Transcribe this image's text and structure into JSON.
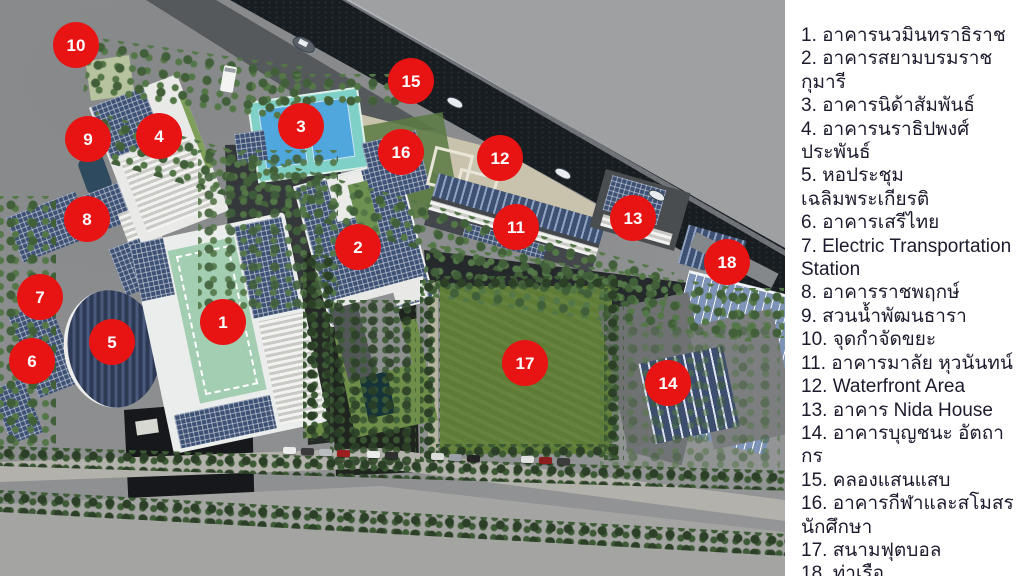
{
  "legend": {
    "items": [
      {
        "number": "1",
        "label": "อาคารนวมินทราธิราช"
      },
      {
        "number": "2",
        "label": "อาคารสยามบรมราชกุมารี"
      },
      {
        "number": "3",
        "label": "อาคารนิด้าสัมพันธ์"
      },
      {
        "number": "4",
        "label": "อาคารนราธิปพงศ์ประพันธ์"
      },
      {
        "number": "5",
        "label": "หอประชุมเฉลิมพระเกียรติ"
      },
      {
        "number": "6",
        "label": "อาคารเสรีไทย"
      },
      {
        "number": "7",
        "label": "Electric Transportation Station"
      },
      {
        "number": "8",
        "label": "อาคารราชพฤกษ์"
      },
      {
        "number": "9",
        "label": "สวนน้ำพัฒนธารา"
      },
      {
        "number": "10",
        "label": "จุดกำจัดขยะ"
      },
      {
        "number": "11",
        "label": "อาคารมาลัย หุวนันทน์"
      },
      {
        "number": "12",
        "label": "Waterfront Area"
      },
      {
        "number": "13",
        "label": "อาคาร Nida House"
      },
      {
        "number": "14",
        "label": "อาคารบุญชนะ อัตถากร"
      },
      {
        "number": "15",
        "label": "คลองแสนแสบ"
      },
      {
        "number": "16",
        "label": "อาคารกีฬาและสโมสรนักศึกษา"
      },
      {
        "number": "17",
        "label": "สนามฟุตบอล"
      },
      {
        "number": "18",
        "label": "ท่าเรือ"
      }
    ]
  },
  "map": {
    "markers": [
      {
        "number": "1",
        "x": 223,
        "y": 322
      },
      {
        "number": "2",
        "x": 358,
        "y": 247
      },
      {
        "number": "3",
        "x": 301,
        "y": 126
      },
      {
        "number": "4",
        "x": 159,
        "y": 136
      },
      {
        "number": "5",
        "x": 112,
        "y": 342
      },
      {
        "number": "6",
        "x": 32,
        "y": 361
      },
      {
        "number": "7",
        "x": 40,
        "y": 297
      },
      {
        "number": "8",
        "x": 87,
        "y": 219
      },
      {
        "number": "9",
        "x": 88,
        "y": 139
      },
      {
        "number": "10",
        "x": 76,
        "y": 45
      },
      {
        "number": "11",
        "x": 516,
        "y": 227
      },
      {
        "number": "12",
        "x": 500,
        "y": 158
      },
      {
        "number": "13",
        "x": 633,
        "y": 218
      },
      {
        "number": "14",
        "x": 668,
        "y": 383
      },
      {
        "number": "15",
        "x": 411,
        "y": 81
      },
      {
        "number": "16",
        "x": 401,
        "y": 152
      },
      {
        "number": "17",
        "x": 525,
        "y": 363
      },
      {
        "number": "18",
        "x": 727,
        "y": 262
      }
    ],
    "boats": [
      {
        "x": 292,
        "y": 38,
        "type": "barge"
      },
      {
        "x": 446,
        "y": 98,
        "type": "boat"
      },
      {
        "x": 554,
        "y": 169,
        "type": "boat"
      },
      {
        "x": 648,
        "y": 191,
        "type": "boat"
      }
    ],
    "cars": [
      {
        "x": 283,
        "y": 447,
        "color": "#ececec"
      },
      {
        "x": 301,
        "y": 448,
        "color": "#3a3a3a"
      },
      {
        "x": 319,
        "y": 449,
        "color": "#b9bcc0"
      },
      {
        "x": 337,
        "y": 450,
        "color": "#9c1d1d"
      },
      {
        "x": 367,
        "y": 451,
        "color": "#ececec"
      },
      {
        "x": 385,
        "y": 452,
        "color": "#2f2f2f"
      },
      {
        "x": 431,
        "y": 453,
        "color": "#dcdcdc"
      },
      {
        "x": 449,
        "y": 454,
        "color": "#9aa0a8"
      },
      {
        "x": 467,
        "y": 455,
        "color": "#222222"
      },
      {
        "x": 521,
        "y": 456,
        "color": "#e2e2e2"
      },
      {
        "x": 539,
        "y": 457,
        "color": "#8c1d1d"
      },
      {
        "x": 557,
        "y": 458,
        "color": "#3c3c3c"
      }
    ]
  },
  "theme": {
    "marker_color": "#e81414",
    "marker_text_color": "#ffffff",
    "water_color": "#181d21",
    "panel_bg": "#ffffff",
    "panel_text_color": "#1b1b2d"
  }
}
